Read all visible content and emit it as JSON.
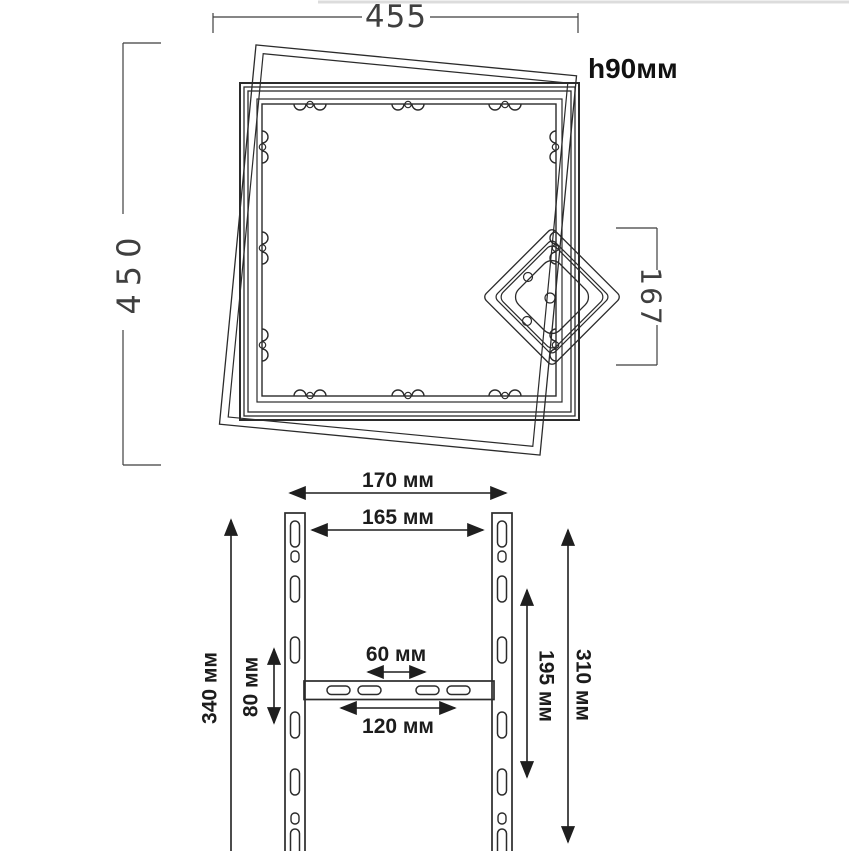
{
  "colors": {
    "line": "#2b2b2b",
    "dim": "#1f1f1f",
    "cad_dim": "#3f3f3f",
    "faint_border": "#dcdcdc"
  },
  "top_view": {
    "width_dim": "455",
    "height_dim": "450",
    "profile_height": "h90мм",
    "corner_plate_dim": "167"
  },
  "bracket_view": {
    "outer_width_dim": "170 мм",
    "hole_span_width_dim": "165 мм",
    "rail_length_dim": "340 мм",
    "crossbar_offset_dim": "80 мм",
    "inner_slot_span_dim": "60 мм",
    "outer_slot_span_dim": "120 мм",
    "inner_height_dim": "195 мм",
    "outer_height_dim": "310 мм"
  }
}
